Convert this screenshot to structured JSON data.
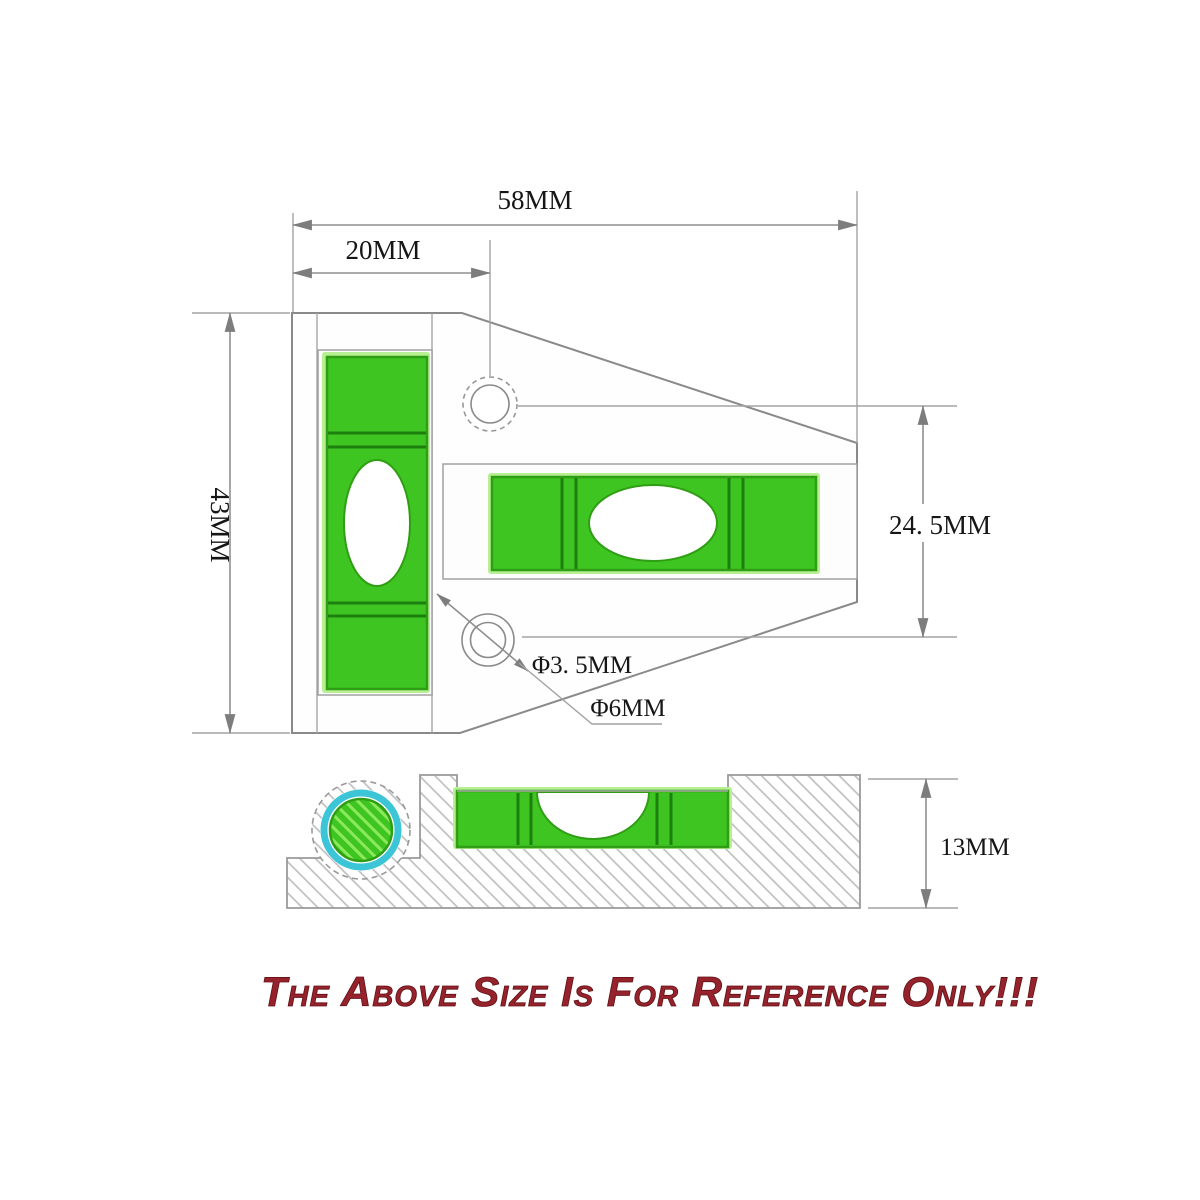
{
  "drawing": {
    "title": "spirit-level-dimension-drawing",
    "dims": {
      "width_total": "58MM",
      "width_left": "20MM",
      "height_total": "43MM",
      "height_right": "24. 5MM",
      "hole_small": "Φ3. 5MM",
      "hole_large": "Φ6MM",
      "thickness": "13MM"
    },
    "dimensions_mm": {
      "width_total": 58,
      "width_left": 20,
      "height_total": 43,
      "height_right": 24.5,
      "hole_small_diameter": 3.5,
      "hole_large_diameter": 6,
      "thickness": 13
    },
    "footer": "The Above Size Is For Reference Only!!!",
    "colors": {
      "vial_green": "#3fc521",
      "vial_green_dark": "#2f9e14",
      "vial_glow": "#b7ef92",
      "ring_cyan": "#3cc5d6",
      "line_gray": "#8a8a8a",
      "text_red": "#96222b"
    }
  }
}
